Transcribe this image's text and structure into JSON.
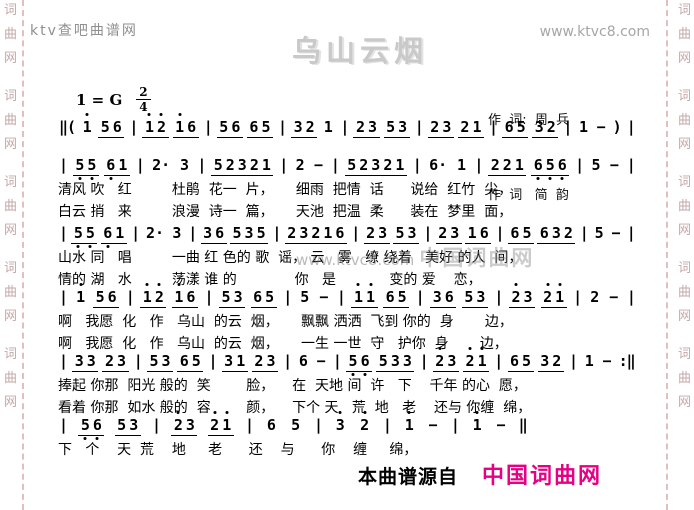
{
  "page": {
    "background": "#ffffff",
    "width": 694,
    "height": 510
  },
  "header": {
    "site_name_left": "ktv查吧曲谱网",
    "site_url_right": "www.ktvc8.com"
  },
  "title": "乌山云烟",
  "credits": {
    "line1": "作  词:  周  兵",
    "line2": "作  词   简  韵"
  },
  "key_signature": {
    "key": "1 = G",
    "meter_top": "2",
    "meter_bottom": "4"
  },
  "watermark": {
    "url_text": "www.ktvc8.com",
    "brand_text": "中国词曲网"
  },
  "side_rails": {
    "vertical_text": "词曲网",
    "repeats": 5,
    "text_color": "#c4a8a8",
    "dash_color": "#e2bfbf"
  },
  "score": {
    "notation_system": "jianpu",
    "systems": [
      {
        "notes": [
          "||(",
          "1'",
          "56",
          "|",
          "1'2'",
          "1'6",
          "|",
          "56",
          "65",
          "|",
          "32",
          "1",
          "|",
          "23",
          "53",
          "|",
          "23",
          "21",
          "|",
          "65",
          "32",
          "|",
          "1",
          "-",
          ")",
          "|"
        ],
        "lyrics": []
      },
      {
        "notes": [
          "|",
          "5,5,",
          "6,1",
          "|",
          "2.",
          "3",
          "|",
          "52321",
          "|",
          "2",
          "-",
          "|",
          "52321",
          "|",
          "6.",
          "1",
          "|",
          "221",
          "6,5,6,",
          "|",
          "5",
          "-",
          "|"
        ],
        "lyrics": [
          "清风 吹   红         杜鹃  花一  片，     细雨  把情  话      说给  红竹  尖，",
          "白云 捎   来         浪漫  诗一  篇，     天池  把温  柔      装在  梦里  面，"
        ]
      },
      {
        "notes": [
          "|",
          "5,5,",
          "6,1",
          "|",
          "2.",
          "3",
          "|",
          "36",
          "535",
          "|",
          "23216",
          "|",
          "23",
          "53",
          "|",
          "23",
          "16",
          "|",
          "65",
          "632",
          "|",
          "5",
          "-",
          "|"
        ],
        "lyrics": [
          "山水 同   唱         一曲 红 色的 歌  谣， 云   雾   缭 绕着   美好 的人  间，",
          "情的 湖   水         荡漾 谁 的             你   是            变的 爱    恋，"
        ]
      },
      {
        "notes": [
          "|",
          "1'",
          "56",
          "|",
          "1'2'",
          "1'6",
          "|",
          "53",
          "65",
          "|",
          "5",
          "-",
          "|",
          "1'1'",
          "65",
          "|",
          "36",
          "53",
          "|",
          "2'3",
          "2'1'",
          "|",
          "2",
          "-",
          "|"
        ],
        "lyrics": [
          "啊   我愿  化   作   乌山  的云  烟，     飘飘 洒洒  飞到 你的  身       边，",
          "啊   我愿  化   作   乌山  的云  烟，     一生 一世  守   护你  身       边，"
        ]
      },
      {
        "notes": [
          "|",
          "33",
          "23",
          "|",
          "53",
          "65",
          "|",
          "31",
          "23",
          "|",
          "6",
          "-",
          "|",
          "5,6,",
          "533",
          "|",
          "2'3",
          "2'1'",
          "|",
          "65",
          "32",
          "|",
          "1",
          "-",
          ":||"
        ],
        "lyrics": [
          "捧起 你那  阳光 般的  笑        脸，    在  天地 间  许   下    千年 的心  愿，",
          "看着 你那  如水 般的  容        颜，    下个 天   荒  地   老    还与 你缠  绵，"
        ]
      },
      {
        "notes": [
          "|",
          "5,6,",
          "53",
          "|",
          "2'3",
          "2'1'",
          "|",
          "6",
          "5",
          "|",
          "3'",
          "2'",
          "|",
          "1'",
          "-",
          "|",
          "1'",
          "-",
          "||"
        ],
        "lyrics": [
          "下   个    天  荒    地     老      还    与      你    缠     绵，"
        ]
      }
    ]
  },
  "footer": {
    "source_label": "本曲谱源自",
    "source_brand": "中国词曲网",
    "brand_color": "#e60084"
  }
}
